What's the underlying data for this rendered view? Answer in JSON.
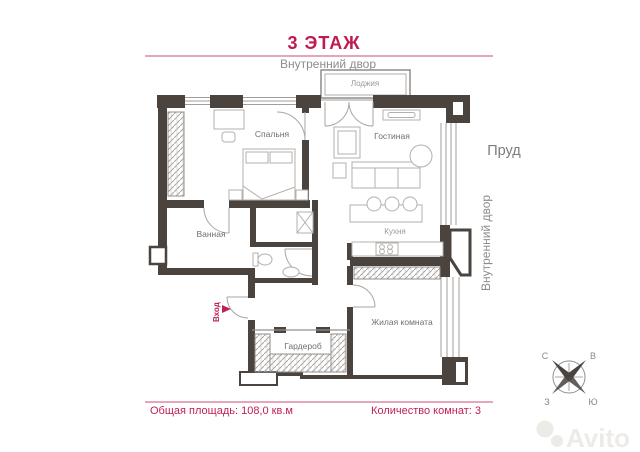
{
  "page": {
    "title_floor": "3 ЭТАЖ"
  },
  "surroundings": {
    "courtyard_top": "Внутренний двор",
    "courtyard_right": "Внутренний двор",
    "pond": "Пруд"
  },
  "rooms": {
    "loggia": "Лоджия",
    "bedroom": "Спальня",
    "living_room": "Гостиная",
    "bathroom": "Ванная",
    "kitchen": "Кухня",
    "habitable_room": "Жилая комната",
    "wardrobe": "Гардероб"
  },
  "entrance_label": "Вход",
  "compass": {
    "north": "С",
    "east": "В",
    "west": "З",
    "south": "Ю"
  },
  "footer": {
    "total_area_label": "Общая площадь: 108,0 кв.м",
    "rooms_count_label": "Количество комнат: 3"
  },
  "watermark": {
    "brand": "Avito"
  },
  "colors": {
    "accent": "#c01a4f",
    "walls": "#4a433e",
    "labels": "#6f6f6f"
  }
}
